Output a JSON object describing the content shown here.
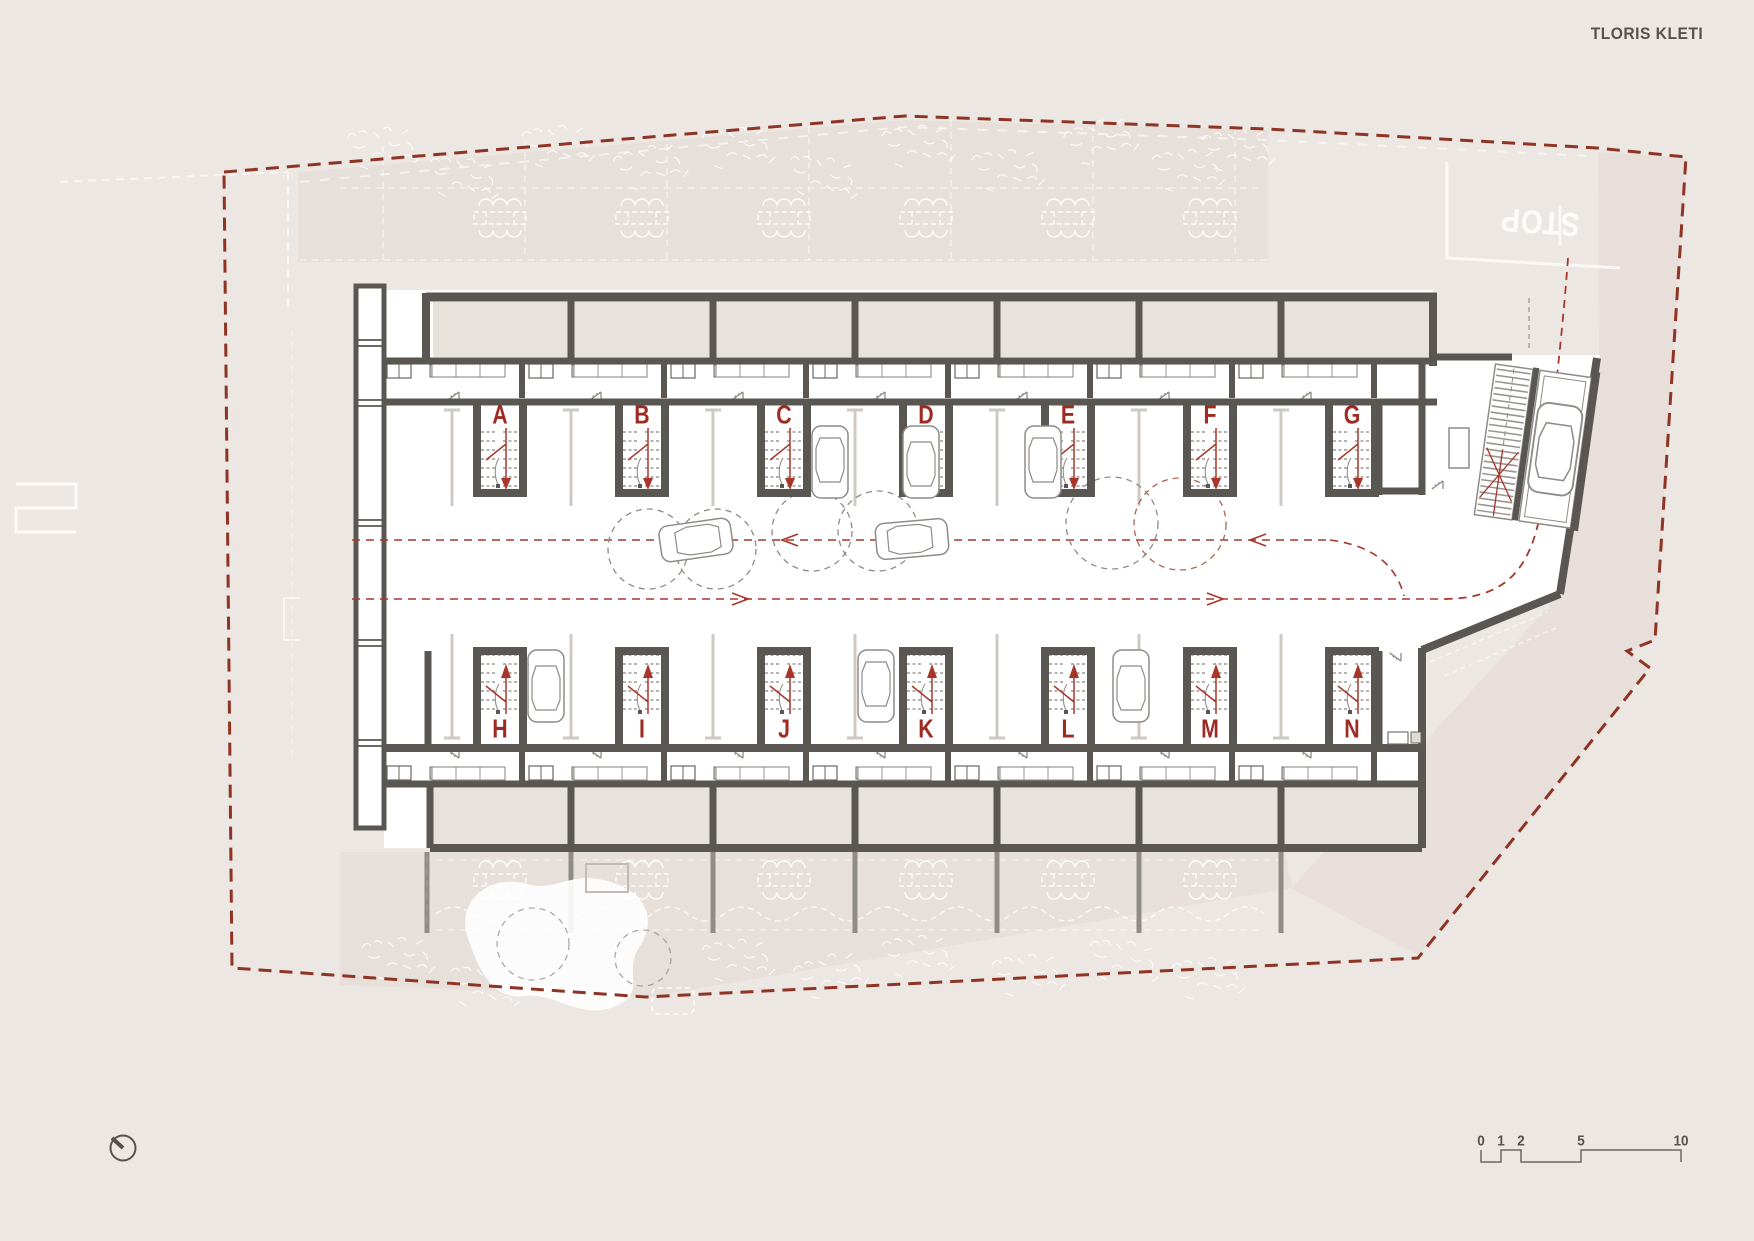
{
  "title": "TLORIS KLETI",
  "stairs": {
    "top": [
      {
        "label": "A"
      },
      {
        "label": "B"
      },
      {
        "label": "C"
      },
      {
        "label": "D"
      },
      {
        "label": "E"
      },
      {
        "label": "F"
      },
      {
        "label": "G"
      }
    ],
    "bottom": [
      {
        "label": "H"
      },
      {
        "label": "I"
      },
      {
        "label": "J"
      },
      {
        "label": "K"
      },
      {
        "label": "L"
      },
      {
        "label": "M"
      },
      {
        "label": "N"
      }
    ]
  },
  "road_marking": {
    "label": "STOP"
  },
  "scale_bar": {
    "ticks": [
      "0",
      "1",
      "2",
      "5",
      "10"
    ]
  },
  "icons": {
    "north_indicator": "circle-with-needle-pointing-up-left"
  },
  "colors": {
    "background": "#ece7e2",
    "panel": "#e7e0da",
    "storage_fill": "#e8e2dc",
    "wall": "#5a5752",
    "stair_label": "#9e2b23",
    "boundary_dash": "#8e3425",
    "drive_dash": "#a8372b",
    "light_marking": "#cfc9c3"
  }
}
